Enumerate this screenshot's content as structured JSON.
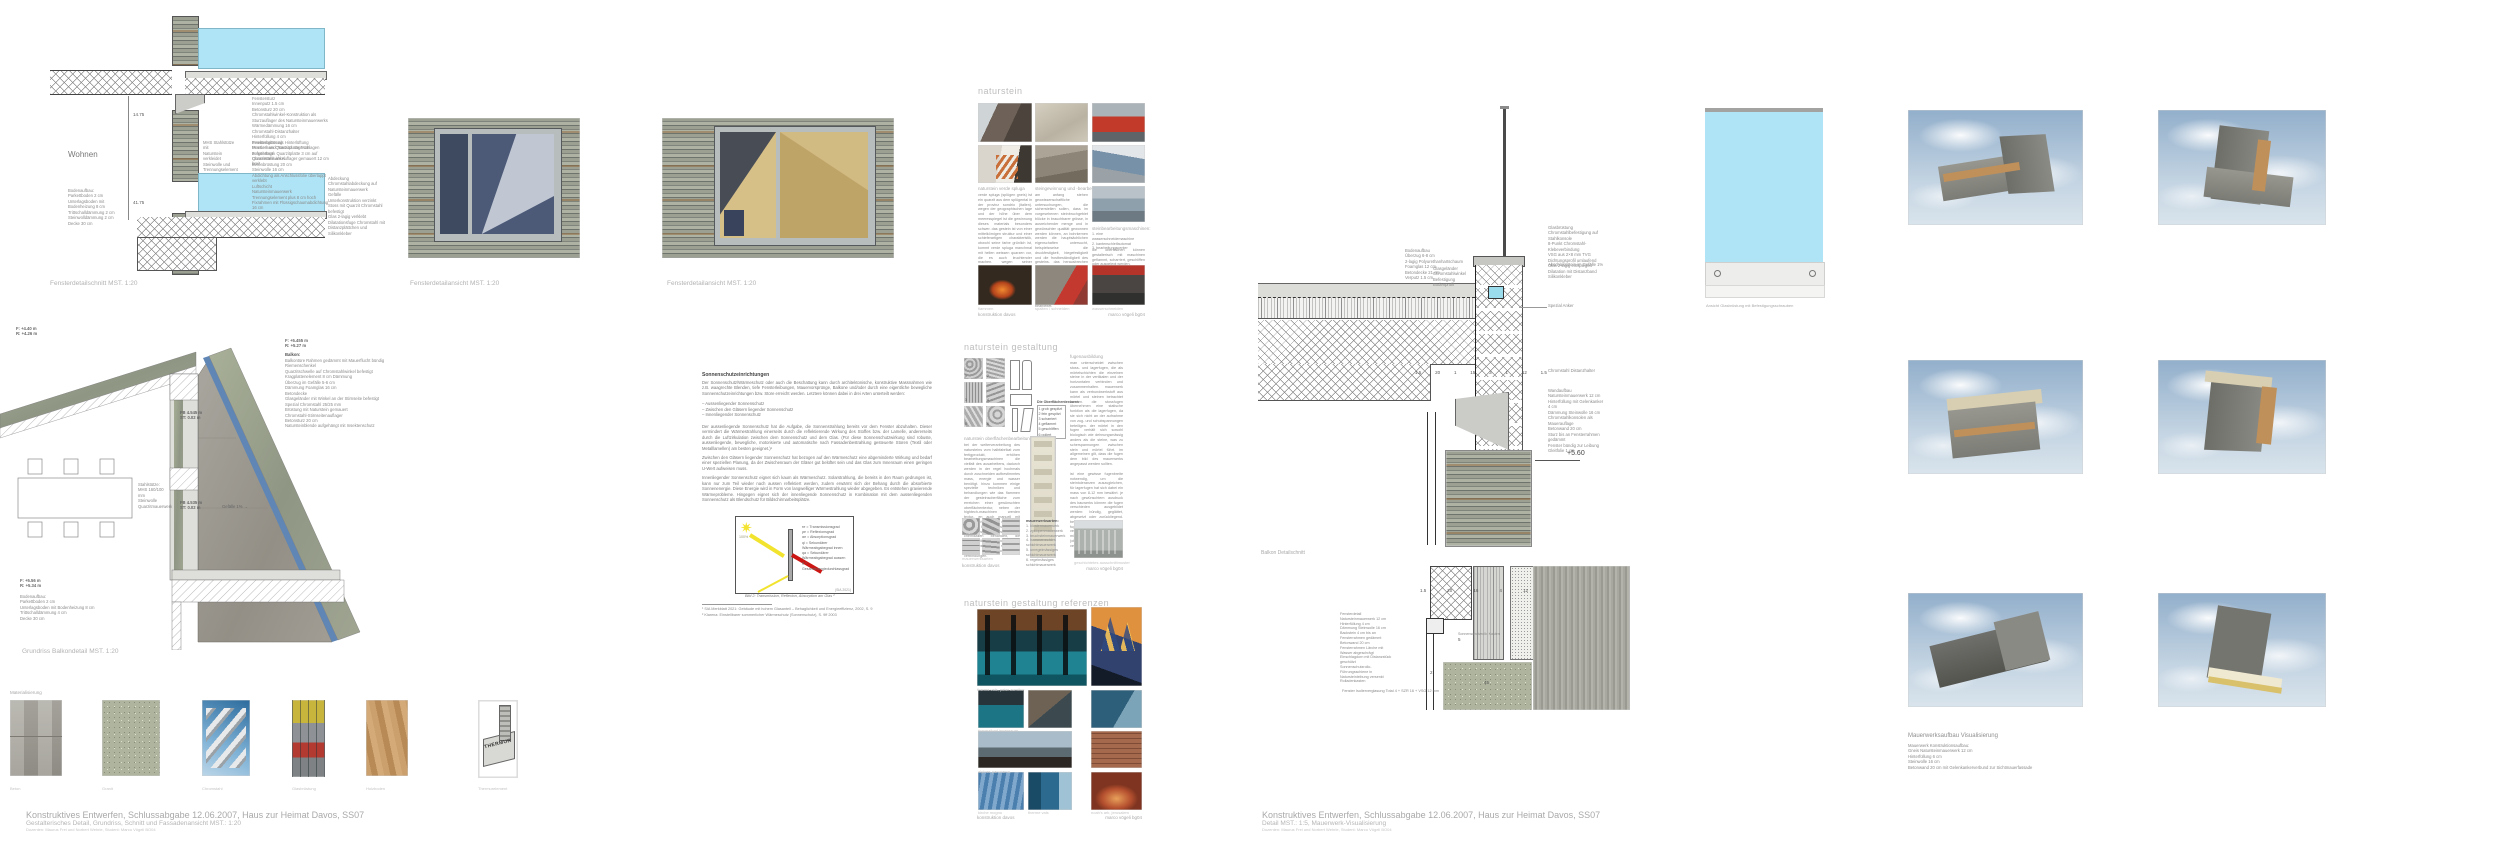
{
  "footer_left": {
    "l1": "Konstruktives Entwerfen, Schlussabgabe 12.06.2007, Haus zur Heimat Davos, SS07",
    "l2": "Gestalterisches Detail, Grundriss, Schnitt und Fassadenansicht MST.: 1:20",
    "l3": "Dozenten: Maurus Frei und Norbert Wehrle, Student: Marco Vögeli BO04"
  },
  "footer_right": {
    "l1": "Konstruktives Entwerfen, Schlussabgabe 12.06.2007, Haus zur Heimat Davos, SS07",
    "l2": "Detail MST.: 1:5, Mauerwerk-Visualisierung",
    "l3": "Dozenten: Maurus Frei und Norbert Wehrle, Student: Marco Vögeli BO04"
  },
  "schnitt": {
    "caption": "Fensterdetailschnitt MST. 1:20",
    "wohnen": "Wohnen",
    "dim1": "14.75",
    "dim2": "41.75",
    "ann_boden": "Bodenaufbau:\nParkettboden 2 cm\nUnterlagsboden mit Bodenheizung 8 cm\nTrittschalldämmung 2 cm\nSteinwolldämmung 2 cm\nDecke 30 cm",
    "ann_stuetze": "MHS Stahlstütze mit\nNaturstein verkleidet\nSteinwolle und\nTrennungselement",
    "ann_sturz": "Fenstersturz\nInnenputz 1.5 cm\nBetonsturz 20 cm\nChromstahlwinkel-Konstruktion als Sturzauflager des Natursteinmauerwerks\nWärmedämmung 16 cm\nChromstahl-Distanzhalter\nHinterfüllung 4 cm\nInsektengitter als Hinterlüftung\nMontierbare Quarzitplatte 3 cm aufgehängt\nQuarzitstein als Auflager gemauert 12 cm breit",
    "ann_bruestung": "Fensterbrüstung\nFenster- und Türsturz angeschlagen\nFensterbank Quarzitplatte 3 cm auf Chromstahlwinkel\nBetonbrüstung 20 cm\nSteinwolle 16 cm\nAbdichtung als Anschlussfolie überlappt verklebt\nLuftschicht\nNatursteinmauerwerk\nTrennungselement plus 8 cm hoch\nFixrahmen mit Flüssigschaumabdichtung 16 cm",
    "ann_abdeckung": "Abdeckung\nChromstahlabdeckung auf Natursteinmauerwerk\nGefälle\nUnterkonstruktion verzinkt\nStoss mit Quarzit Chromstahl befestigt\nGlas 2-lagig verklebt\nDilatationsfuge Chromstahl mit Distanzplättchen und Silikonkleber"
  },
  "ansicht": {
    "caption1": "Fensterdetailansicht MST. 1:20",
    "caption2": "Fensterdetailansicht MST. 1:20"
  },
  "plan": {
    "caption": "Grundriss Balkondetail MST. 1:20",
    "level_tl": "F: +4.40 m\nR: +4.26 m",
    "level_tr": "F: +5.455 m\nR: +5.27 m",
    "level_bl": "F: +5.56 m\nR: +5.34 m",
    "balkon_title": "Balkon:",
    "balkon_lines": "Balkontüre Rahmen gedämmt mit Mauerflucht bündig\nRiemenschenkel\nQuarzitschwelle auf Chromstahlwinkel befestigt\nKragplattenelement 8 cm Dämmung\nÜberzug im Gefälle 5-6 cm\nDämmung Foamglas 16 cm\nBetondecke\nGlasgeländer mit Winkel an der Stirnseite befestigt\nSpezial Chromstahl 25/25 mm\nBrüstung mit Naturstein gemauert\nChromstahl-Stirnseitenauflager\nBetonsturz 20 cm\nNatursteinblende aufgehängt mit Insektenschutz",
    "fb1": "FB 4.545 m\nST: 0.02 m",
    "fb2": "FB 4.535 m\nST: 0.02 m",
    "gefaelle": "Gefälle 1% →",
    "stuetze": "Stahlstütze:\nMHS 160/100 mm\nSteinwolle\nQuarzitmauerwerk",
    "bodenaufbau": "Bodenaufbau:\nParkettboden 2 cm\nUnterlagsboden mit Bodenheizung 8 cm\nTrittschalldämmung 4 cm\nDecke 30 cm"
  },
  "material": {
    "heading": "Materialisierung",
    "items": [
      "Beton",
      "Granit",
      "Chromstahl",
      "Glasbrüstung",
      "Holzboden",
      "Thermurelement"
    ],
    "thermur": "THERMUR"
  },
  "sonnenschutz": {
    "heading": "Sonnenschutzeinrichtungen",
    "p1": "Der Sonnenschutz/Wärmeschutz oder auch die Beschattung kann durch architektonische, konstruktive Massnahmen wie z.B. waagrechte Blenden, tiefe Fensterleibungen, Mauervorsprünge, Balkone und/oder durch eine eigentliche bewegliche Sonnenschutzeinrichtungen bzw. Store erreicht werden. Letztere können dabei in drei Arten unterteilt werden:",
    "bullets": "–  Aussenliegender Sonnenschutz\n–  Zwischen den Gläsern liegender Sonnenschutz\n–  Innenliegender Sonnenschutz",
    "p2": "Der aussenliegende Sonnenschutz hat die Aufgabe, die Sonnenstrahlung bereits vor dem Fenster abzuhalten. Dieser vermindert die Wärmestrahlung einerseits durch die reflektierende Wirkung des Stoffes bzw. der Lamelle, andererseits durch die Luftzirkulation zwischen dem Sonnenschutz und dem Glas. (Für diese Sonnenschutzwirkung sind robuste, aussenliegende, bewegliche, motorisierte und automatische nach Fassadenbestrahlung gesteuerte Storen (Textil oder Metalllamellen) am besten geeignet.)¹",
    "p3": "Zwischen den Gläsern liegender Sonnenschutz hat bezogen auf den Wärmeschutz eine abgeminderte Wirkung und bedarf einer speziellen Planung, da der Zwischenraum der Gläser gut belüftet sein und das Glas zum Innenraum einen geringen U-Wert aufweisen muss.",
    "p4": "Innenliegender Sonnenschutz eignet sich kaum als Wärmeschutz. Solarstrahlung, die bereits in den Raum gedrungen ist, kann nur zum Teil wieder nach aussen reflektiert werden, zudem erwärmt sich der Behang durch die absorbierte Sonnenenergie. Diese Energie wird in Form von langwelliger Wärmestrahlung wieder abgegeben. Es entstehen gravierende Wärmeprobleme. Hingegen eignet sich der innenliegende Sonnenschutz in Kombination mit dem aussenliegenden Sonnenschutz als Blendschutz für Bildschirmarbeitsplätze.",
    "diagram_pct": "100%",
    "diagram_legend": "τe = Transmissionsgrad\nρe = Reflexionsgrad\nαe = Absorptionsgrad\nqi = Sekundärer Wärmeabgabegrad innen\nqa = Sekundärer Wärmeabgabegrad aussen\ng = Gesamtenergiedurchlassgrad",
    "diagram_src": "(SIA 2021)",
    "bild2": "Bild 2: Transmission, Reflexion, Absorption am Glas ²",
    "fn1": "¹ SIA Merkblatt 2021: Gebäude mit hohem Glasanteil – Behaglichkeit und Energieeffizienz, 2002, S. 9",
    "fn2": "² Klarena: Einstellbarer sommerlicher Wärmeschutz (Sonnenschutz), S. 9ff 2003"
  },
  "naturstein": {
    "heading": "naturstein",
    "c1_title": "naturstein verde spluga",
    "c1_text": "verde spluga (splügen gneis) ist ein quarzit aus dem splügental in der provinz sondrio (italien). wegen der geographischen lage und der höhe über dem meeresspiegel ist die gewinnung dieses materials besonders schwer. das gestein ist von einer mittelkörnigen struktur und einer schieferartigen charakteristik, obwohl seine farbe grünlich ist, kommt verde spluga manchmal mit hellen weissen quarzen vor, die es auch leuchtender machen. wegen seiner eigenschaften ist dieses gestein sowohl für innenausbauten als auch für aussenarbeiten verwendbar, bei besonders präziser bearbeitung geeignet.",
    "c2_title": "steingewinnung und -bearbeitung",
    "c2_text": "am anfang stehen geowissenschaftliche untersuchungen, die sicherstellen sollen, dass im vorgesehenen steinbruchgebiet blöcke in brauchbarer grösse, in ausreichender menge und in gewünschter qualität gewonnen werden können, an bohrkernen werden die hauptsächlichen eigenschaften untersucht, beispielsweise die druckfestigkeit, biegefestigkeit und die frostbeständigkeit des gesteins. das herausbrechen des gesteins erfolgt dem gestein entsprechend mit diamantseilsägen, schrämen oder durch sprengen, die blöcke werden anschliessend mit gattersägen oder seilsägen zu platten und tranchen geschnitten und weiter bearbeitet.",
    "c3_title": "steinbearbeitungsmaschinen:",
    "c3_list": "1. eine wasserschneidemaschine\n2. kantenschleifautomat\n3. bearbeitungscenter",
    "c3_text": "die oberflächen können gestalterisch mit maschinen geflammt, scharriert, geschliffen oder ausgelegt werden.",
    "cap_photo1": "flammen",
    "cap_photo2": "spalten / schneiden",
    "cap_photo3": "wasserschneiden",
    "cap_left": "konstruktion davos",
    "cap_right": "marco vögeli bg04"
  },
  "gestaltung": {
    "heading": "naturstein gestaltung",
    "fugen_title": "fugenausbildung",
    "fugen_text": "man unterscheidet zwischen stoss- und lagerfugen, die als mörtelschichten die einzelnen steine in der vertikalen und der horizontalen verbinden und zusammenhalten. mauerwerk kann als verbundwerkstoff aus mörtel und steinen betrachtet werden. die stossfugen übernehmen eine statische funktion als die lagerfugen, da sie sich nicht an der aufnahme von zug- und schubspannungen beteiligen. der mörtel in den fugen verhält sich sowohl biologisch wie dehnungsmässig anders als die steine, was zu scherspannungen zwischen stein und mörtel führt. im allgemeinen gilt, dass die fugen dem bild des mauerwerks angepasst werden sollten.\n\nist eine gewisse fugenbreite notwendig, um die steintoleranzen auszugleichen, für lagerfugen hat sich dabei ein mass von 8-12 mm bewährt. je nach gewünschtem ausdruck des bauwerks können die fugen verschieden ausgebildet werden: bündig, geglättet, abgesetzt oder zurückliegend. bei sichtmauerwerk werden die fugen besonders sorgfältig verarbeitet, besteht auch die möglichkeit, die steine knirsch (ohne stossfugenmörtel) zu vermauern.",
    "texturen_title": "Die Oberflächentexturen",
    "texturen_list": "1  grob gespitzt\n2  fein gespitzt\n3  scharriert\n4  geflammt\n5  geschliffen\n6  poliert",
    "ober_title": "naturstein oberflächenbearbeitung",
    "ober_text": "bei der weiterverarbeitung des natursteins vom halbfabrikat zum fertigprodukt, erhöhen bearbeitungsmaschinen die vielfalt des ausarbeitens, dadurch werden in der regel hochmals durch zuschneiden aufbestimmtes mass, energie und wasser benötigt. hinzu kommen einige spezielle techniken und behandlungen wie das flammen der gesteinsoberfläche zum erreichen einer gewünschten oberflächentextur, neben der hightech-maschinen werden textur- en auch manuell mit hydraulischem satz durch den steinmetz bearbeitet, seit neuerer zeit lassen naturstein- mit chemikalien behandelt, die flecken- bildung verhindern sollen, die dazu verwendeten substanzen basieren auf organischen verbindungen.",
    "mauer_title": "mauerwerksarten:",
    "mauer_list": "1. klostermauerwerk\n2. zyklopenmauerwerk\n3. bruchsteinmauerwerk\n4. hammerrechtes schichtmauerwerk\n5. unregelmässiges schichtmauerwerk\n6. regelmässiges schichtmauerwerk",
    "mauer_caption": "mauerwerksarten",
    "photo_caption": "geschichtetes ausschnittmuster",
    "cap_left": "konstruktion davos",
    "cap_right": "marco vögeli bg04",
    "tx_nums": [
      "1",
      "2",
      "3",
      "4",
      "5",
      "6"
    ]
  },
  "referenzen": {
    "heading": "naturstein gestaltung referenzen",
    "cap_r1a": "therme vals, peter zumthor",
    "cap_r2a": "thermalbad innenraum",
    "cap_r3a": "alpines panorama",
    "cap_r4a": "kirche mogno",
    "cap_r4b": "therme vals",
    "cap_r4c": "noah's ark, jerusalem",
    "cap_left": "konstruktion davos",
    "cap_right": "marco vögeli bg04"
  },
  "detail_a": {
    "caption": "Balkon Detailschnitt",
    "ann_boden": "Bodenaufbau\nÜberzug 6-8 cm\n2-lagig Polyurethanhartschaum\nFoamglas 12 cm\nBetondecke 21 cm\nVerputz 1.5 cm",
    "ann_glas": "Glasgeländer\nChromstahlwinkel\nBefestigung\nBodenprofil",
    "ann_rand": "Glasbrüstung\nChromstahlbefestigung auf Stahlkonsole\n8-Punkt Chromstahl-Klebeverbindung\nVSG aus 2×8 mm TVG\nDichtungsprofil umlaufend\nGlas 2-lagig entspiegelt\nDilatation mit Distanzband\nSilikonkleber",
    "ann_abschluss": "Abschlussstein im Gefälle 1%",
    "ann_anker": "Spezial Anker",
    "ann_distanz": "Chromstahl Distanzhalter",
    "ann_wand": "Wandaufbau\nNatursteinmauerwerk 12 cm\nHinterfüllung mit Gelenkanker 4 cm\nDämmung Steinwolle 16 cm\nChromstahlkonsolen als Mauerauflage\nBetonwand 20 cm\nSturz bis an Fensterrahmen gedämmt\nFenster bündig zur Leibung\nGleitfolie 1 cm",
    "dims": [
      "1.5",
      "20",
      "1",
      "15",
      "3",
      "1",
      "12",
      "1.5"
    ],
    "level": "+5.60"
  },
  "detail_b": {
    "caption": "Fenster Isolierverglasung Total 4 + SZR 16 + VSG 12 mm",
    "ann_left": "Fensterdetail\nNatursteinmauerwerk 12 cm\nHinterfüllung 4 cm\nDämmung Steinwolle 16 cm\nBackstein 4 cm bis an Fensterrahmen gedämmt\nBetonwand 20 cm\nFensterrahmen Lärche mit Wasser abgeschrägt\nEinschlagdorn mit Distanzstück geschützt\nSonnenschutzrollo-Führungsschiene in Natursteinleibung versenkt\nRolladenkasten",
    "ann_rollo": "Sonnenschutzrollo Kasten",
    "dims": [
      "1.5",
      "20",
      "16",
      "4",
      "12"
    ],
    "d45": "45",
    "d5": "5",
    "d2": "2"
  },
  "glaspanel": {
    "caption": "Ansicht Glasbrüstung mit Befestigungsschrauben"
  },
  "viz": {
    "title": "Mauerwerksaufbau Visualisierung",
    "lines": "Mauerwerk Konstruktionsaufbau:\nGneis Natursteinmauerwerk 12 cm\nHinterfüllung 6 cm\nSteinwolle 16 cm\nBetonwand 20 cm mit Gelenkankerverbund zur Sichtmauerfassade"
  }
}
